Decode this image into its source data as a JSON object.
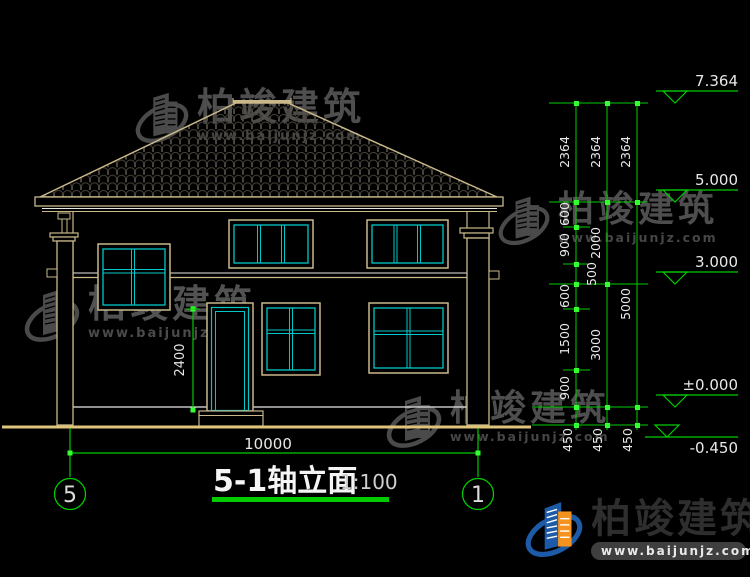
{
  "drawing": {
    "title": "5-1轴立面",
    "scale": "1:100",
    "axis_left": "5",
    "axis_right": "1",
    "overall_width_dim": "10000",
    "door_height_dim": "2400",
    "elevations": {
      "ridge": "7.364",
      "eave": "5.000",
      "floor2": "3.000",
      "ground": "±0.000",
      "grade": "-0.450"
    },
    "chains": {
      "roof": [
        "2364",
        "2364",
        "2364"
      ],
      "inner": [
        "600",
        "900",
        "500",
        "600",
        "1500",
        "900"
      ],
      "middle": [
        "2000",
        "3000"
      ],
      "outer": [
        "5000"
      ],
      "base": [
        "450",
        "450",
        "450"
      ]
    }
  },
  "watermark": {
    "brand": "柏竣建筑",
    "url": "www.baijunjz.com"
  },
  "colors": {
    "line_tan": "#c8b88a",
    "line_white": "#e8e8e8",
    "glass_teal": "#00c8c8",
    "dim_green": "#00cc00",
    "ground_yellow": "#dfc57b",
    "logo_blue": "#1d5aa8",
    "logo_orange": "#f6921e"
  }
}
